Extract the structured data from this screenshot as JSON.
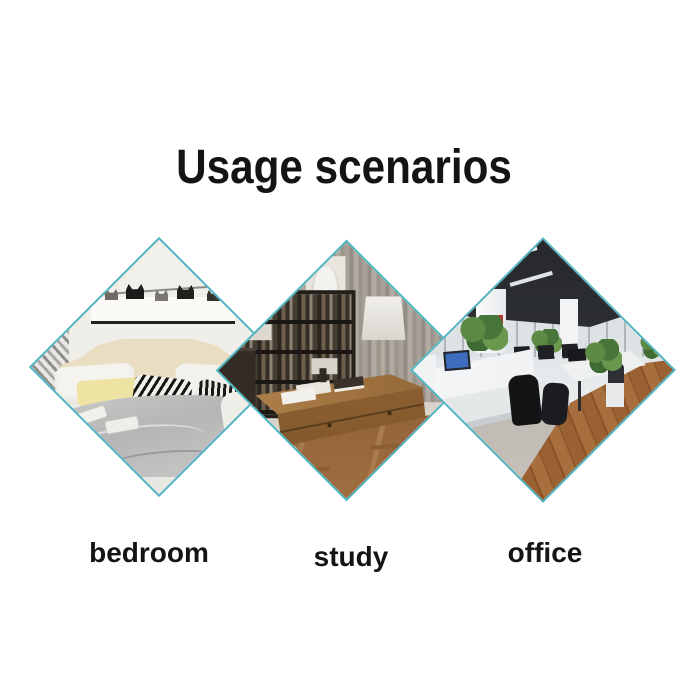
{
  "header": {
    "title": "Usage scenarios"
  },
  "accent": {
    "diamond_border": "#4fb4c3",
    "title_color": "#141414",
    "label_color": "#141414"
  },
  "scenarios": [
    {
      "label": "bedroom",
      "image_alt": "bedroom with cream headboard, grey duvet, yellow and zebra pillows, cat artwork shelf"
    },
    {
      "label": "study",
      "image_alt": "study with dark bookshelf, white bust, drum lamp and wooden trestle desk"
    },
    {
      "label": "office",
      "image_alt": "open plan office with white desks, black chairs, plants and wooden floor"
    }
  ]
}
